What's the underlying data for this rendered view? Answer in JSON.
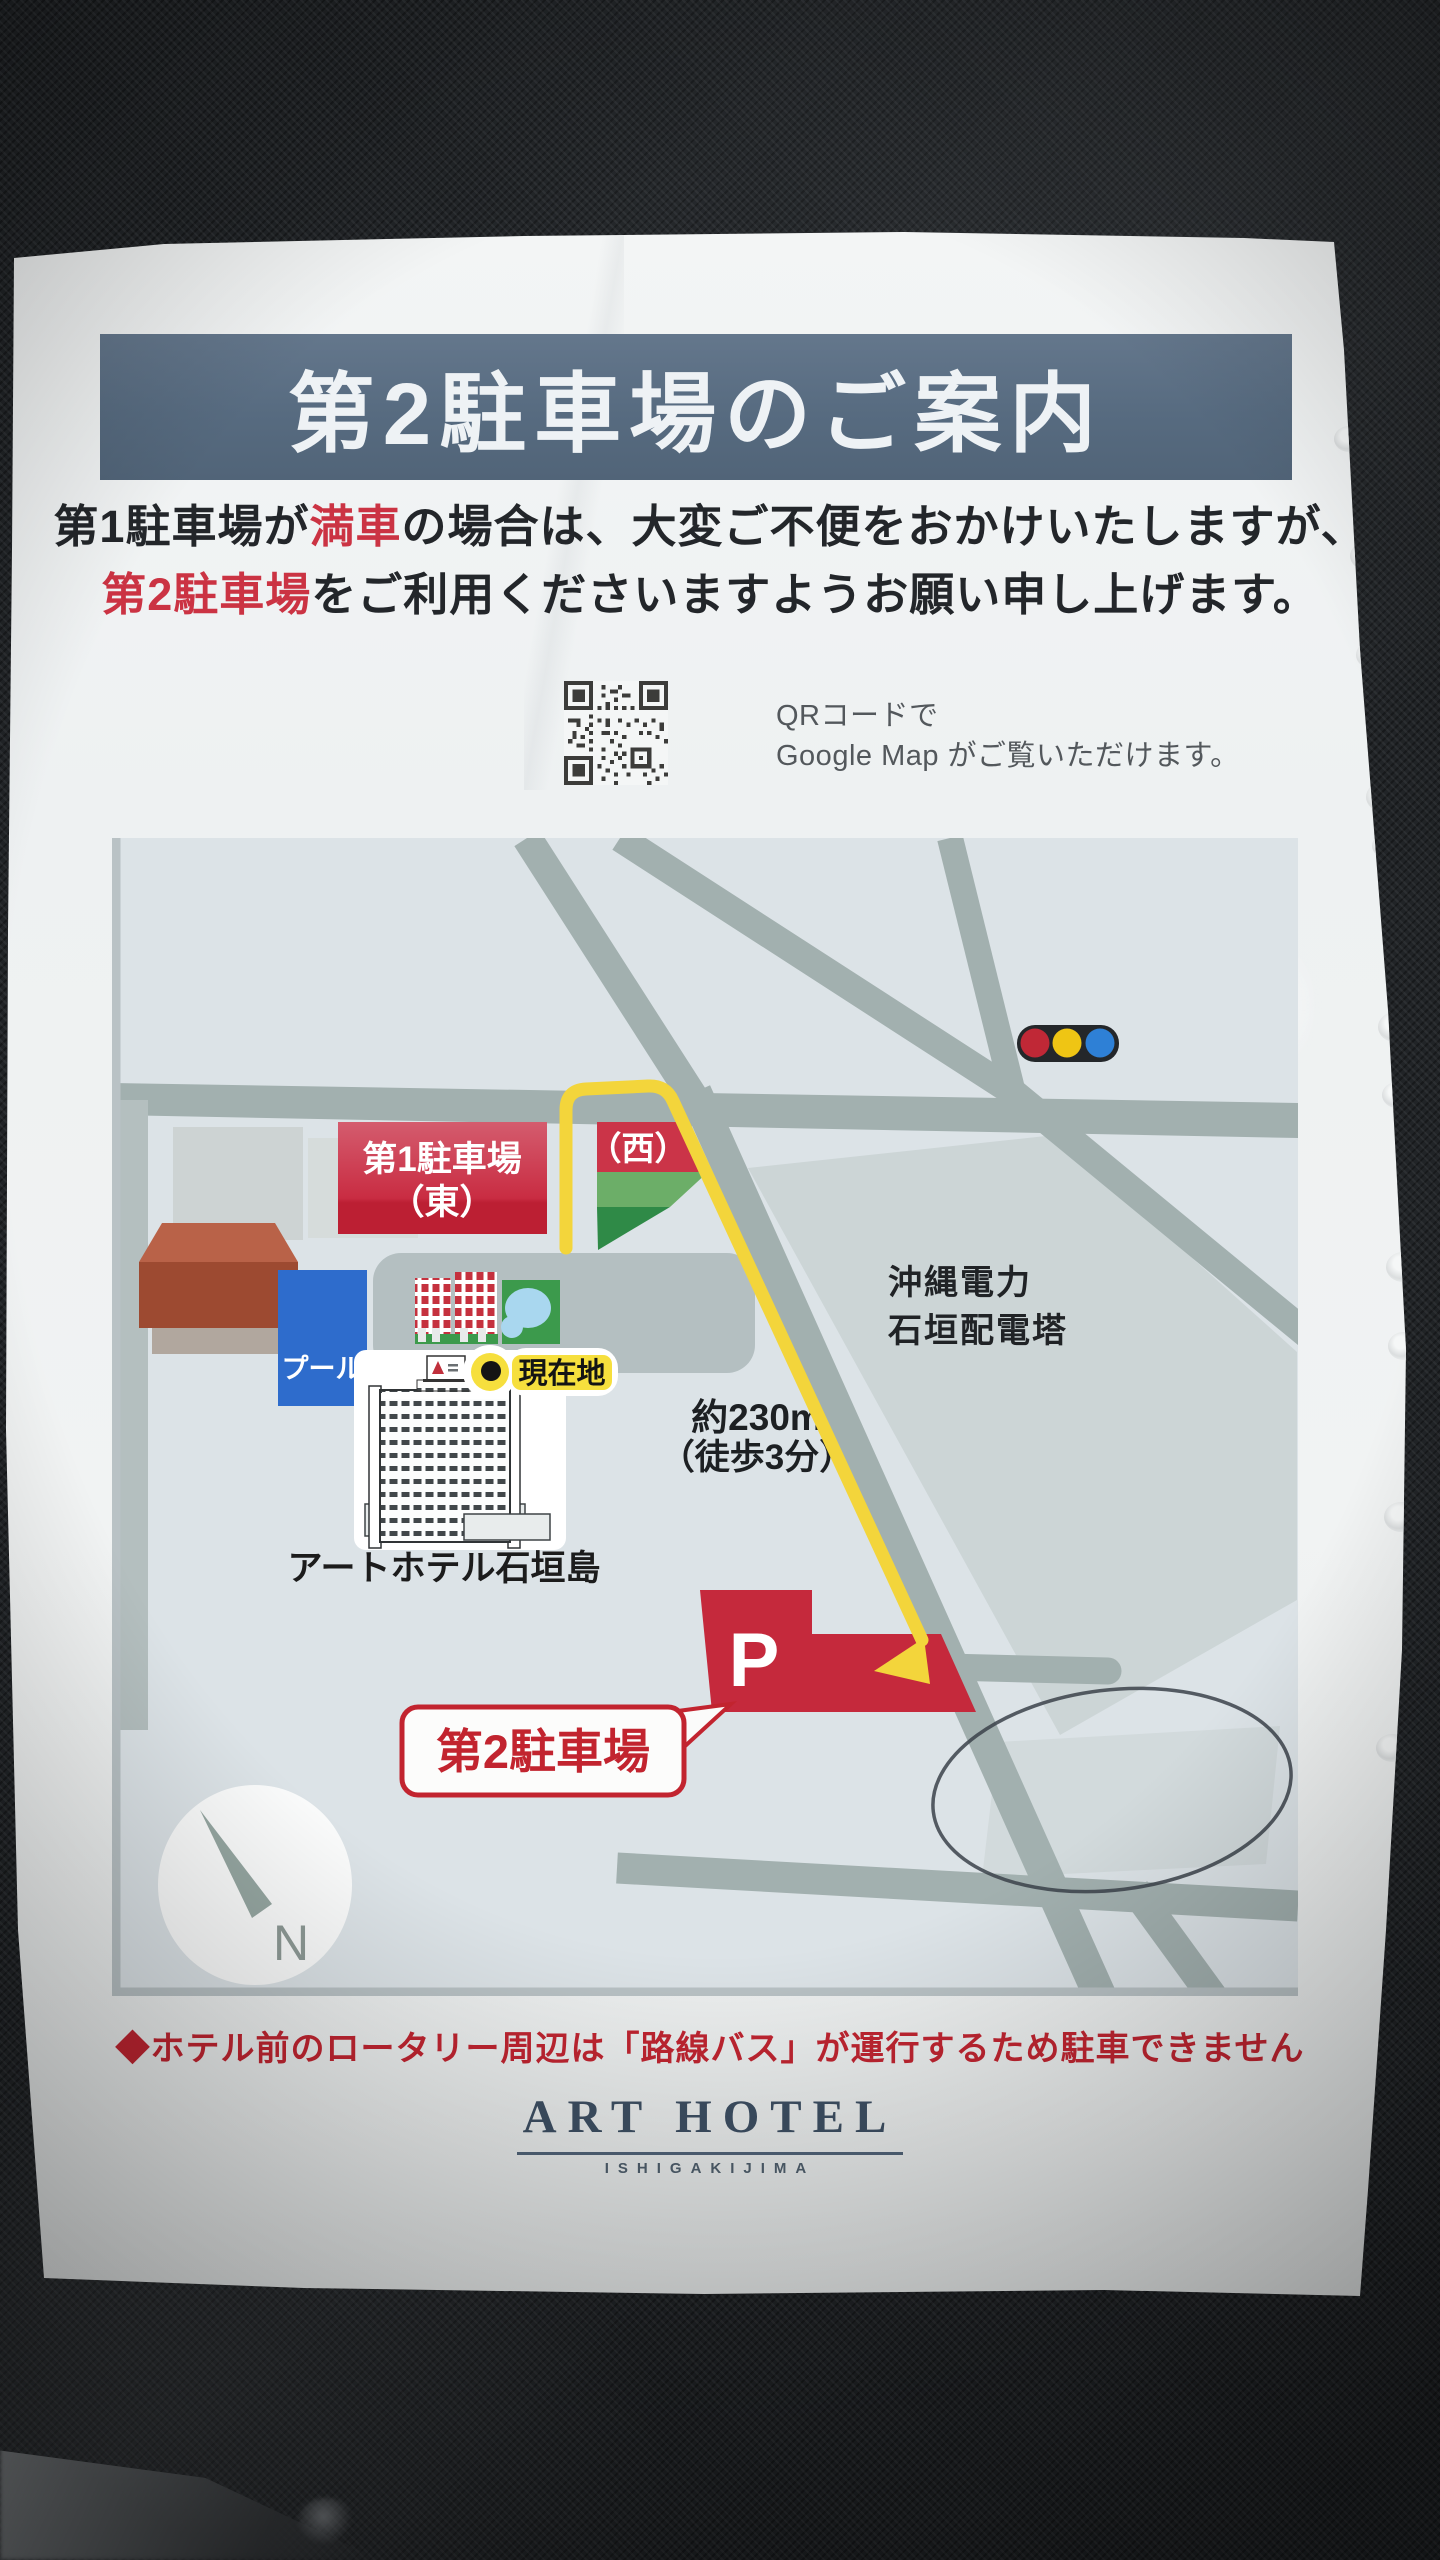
{
  "title": "第2駐車場のご案内",
  "notice": {
    "l1a": "第1駐車場が",
    "l1b": "満車",
    "l1c": "の場合は、大変ご不便をおかけいたしますが、",
    "l2a": "第2駐車場",
    "l2b": "をご利用くださいますようお願い申し上げます。"
  },
  "qr": {
    "caption_line1": "QRコードで",
    "caption_line2": "Google Map がご覧いただけます。"
  },
  "map": {
    "lot1_east": {
      "line1": "第1駐車場",
      "line2": "（東）"
    },
    "lot1_west": "（西）",
    "substation": {
      "line1": "沖縄電力",
      "line2": "石垣配電塔"
    },
    "pool": "プール",
    "current_location": "現在地",
    "distance": {
      "line1": "約230m",
      "line2": "（徒歩3分）"
    },
    "hotel_name": "アートホテル石垣島",
    "p_mark": "P",
    "lot2": "第2駐車場",
    "compass_n": "N"
  },
  "footer": {
    "warning": "◆ホテル前のロータリー周辺は「路線バス」が運行するため駐車できません",
    "logo": "ART HOTEL",
    "logo_sub": "ISHIGAKIJIMA"
  },
  "colors": {
    "banner_slate": "#576b80",
    "accent_red": "#c5293c",
    "route_yellow": "#f3d53b",
    "map_background": "#dce3e7",
    "road_gray": "#a2b0af",
    "pool_blue": "#2e6ccc",
    "lawn_green": "#3c9a4c",
    "signal_red": "#c02836",
    "signal_yellow": "#efc514",
    "signal_blue": "#2e80d6"
  }
}
